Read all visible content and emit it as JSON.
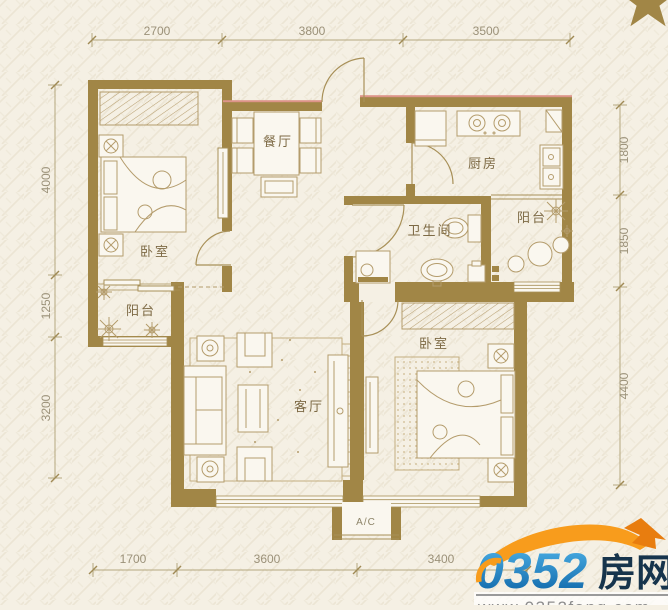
{
  "dimensions": {
    "top": [
      "2700",
      "3800",
      "3500"
    ],
    "left": [
      "4000",
      "1250",
      "3200"
    ],
    "right": [
      "1800",
      "1850",
      "4400"
    ],
    "bottom": [
      "1700",
      "3600",
      "3400"
    ]
  },
  "rooms": {
    "bedroom_left": "卧室",
    "dining": "餐厅",
    "kitchen": "厨房",
    "bathroom": "卫生间",
    "balcony_right": "阳台",
    "balcony_left": "阳台",
    "living": "客厅",
    "bedroom_right": "卧室",
    "ac_unit": "A/C"
  },
  "logo": {
    "site_number": "0352",
    "site_name": "房网",
    "website": "www.0352fang.com"
  },
  "colors": {
    "wall": "#a18646",
    "furniture_line": "#b49c6c",
    "dimension_line": "#b5a87f",
    "dimension_text": "#9b9179",
    "room_text": "#7d6a45",
    "accent_red": "#dd9489",
    "logo_blue_light": "#4fb3e8",
    "logo_blue_dark": "#0b61a4",
    "logo_navy": "#16344c",
    "logo_orange": "#f89c1c",
    "website_gray": "#8e8e8e",
    "background": "#f5f0e4"
  }
}
